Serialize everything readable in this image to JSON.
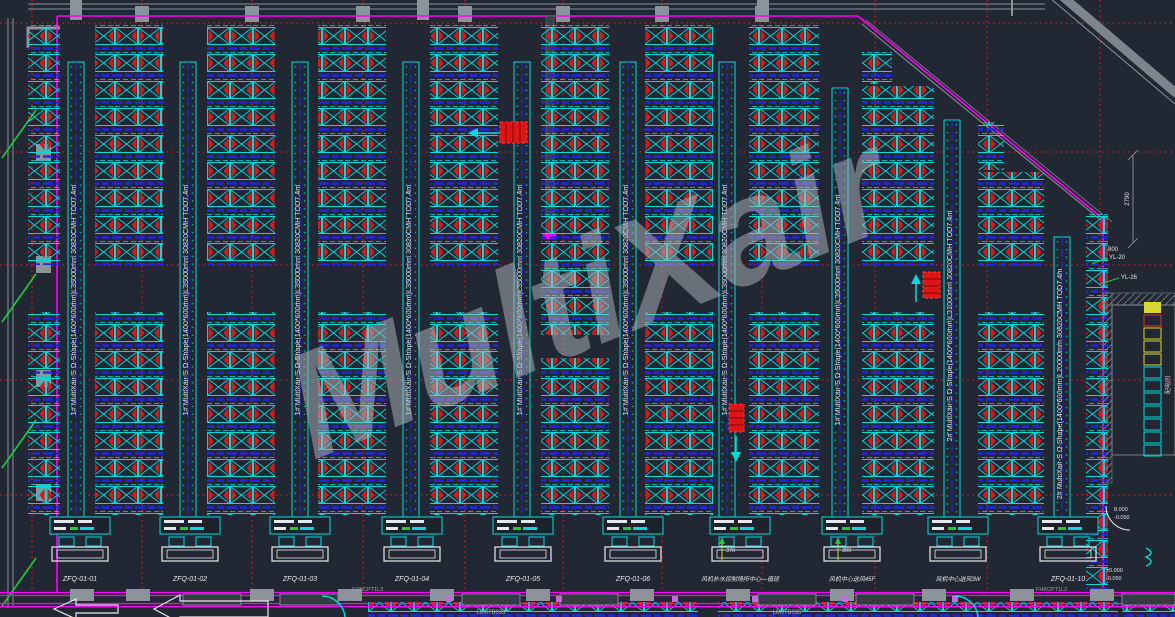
{
  "watermark": {
    "text": "MultiXair"
  },
  "colors": {
    "background": "#212733",
    "rack_cyan": "#00dcdc",
    "rack_red": "#cf1d1d",
    "grid_red": "#ff1515",
    "boundary_magenta": "#ff00ff",
    "beam_blue": "#2424e8",
    "wall_gray": "#8d939b",
    "tick_green": "#18cf3c",
    "panel_yellow": "#d8d832",
    "text_white": "#e6e8ee"
  },
  "ducts": [
    {
      "label": "1# MultiXair-S Ω-Shape(1400*600mm)L35000mm 30820CMH TOD7.4m"
    },
    {
      "label": "1# MultiXair-S Ω-Shape(1400*600mm)L35000mm 30820CMH TOD7.4m"
    },
    {
      "label": "1# MultiXair-S Ω-Shape(1400*600mm)L35000mm 30820CMH TOD7.4m"
    },
    {
      "label": "1# MultiXair-S Ω-Shape(1400*600mm)L35000mm 30820CMH TOD7.4m"
    },
    {
      "label": "1# MultiXair-S Ω-Shape(1400*600mm)L35000mm 30820CMH TOD7.4m"
    },
    {
      "label": "1# MultiXair-S Ω-Shape(1400*600mm)L35000mm 30820CMH TOD7.4m"
    },
    {
      "label": "1# MultiXair-S Ω-Shape(1400*600mm)L35000mm 30820CMH TOD7.4m"
    },
    {
      "label": "1# MultiXair-S Ω-Shape(1400*600mm)L35000mm 30820CMH TOD7.4m"
    },
    {
      "label": "2# MultiXair-S Ω-Shape(1400*600mm)L31000mm 30820CMH TOD7.4m"
    },
    {
      "label": "2# MultiXair-S Ω-Shape(1400*600mm)L20000mm 30820CMH TOD7.4m"
    }
  ],
  "bays": [
    {
      "label": "ZFQ-01-01"
    },
    {
      "label": "ZFQ-01-02"
    },
    {
      "label": "ZFQ-01-03"
    },
    {
      "label": "ZFQ-01-04"
    },
    {
      "label": "ZFQ-01-05"
    },
    {
      "label": "ZFQ-01-06"
    },
    {
      "label": "风机补水控制场所中心—值班"
    },
    {
      "label": "风机中心送风45F"
    },
    {
      "label": "风机中心送风3W"
    },
    {
      "label": "ZFQ-01-10"
    }
  ],
  "annotations": {
    "yl_20": "YL-20",
    "yl_26": "YL-26",
    "dim_2790": "2790",
    "dim_800": "800",
    "dim_370": "370",
    "dim_300": "300",
    "elev_top": "8.000",
    "elev_top2": "-0.050",
    "elev_bot": "±0.000",
    "elev_bot2": "-0.050",
    "room_tag": "配电间",
    "door_tag_left": "FHKCPT1L3",
    "door_tag_right": "FHKCPT1L2",
    "window_tag_1": "LM07B033",
    "window_tag_2": "LM07B035"
  }
}
